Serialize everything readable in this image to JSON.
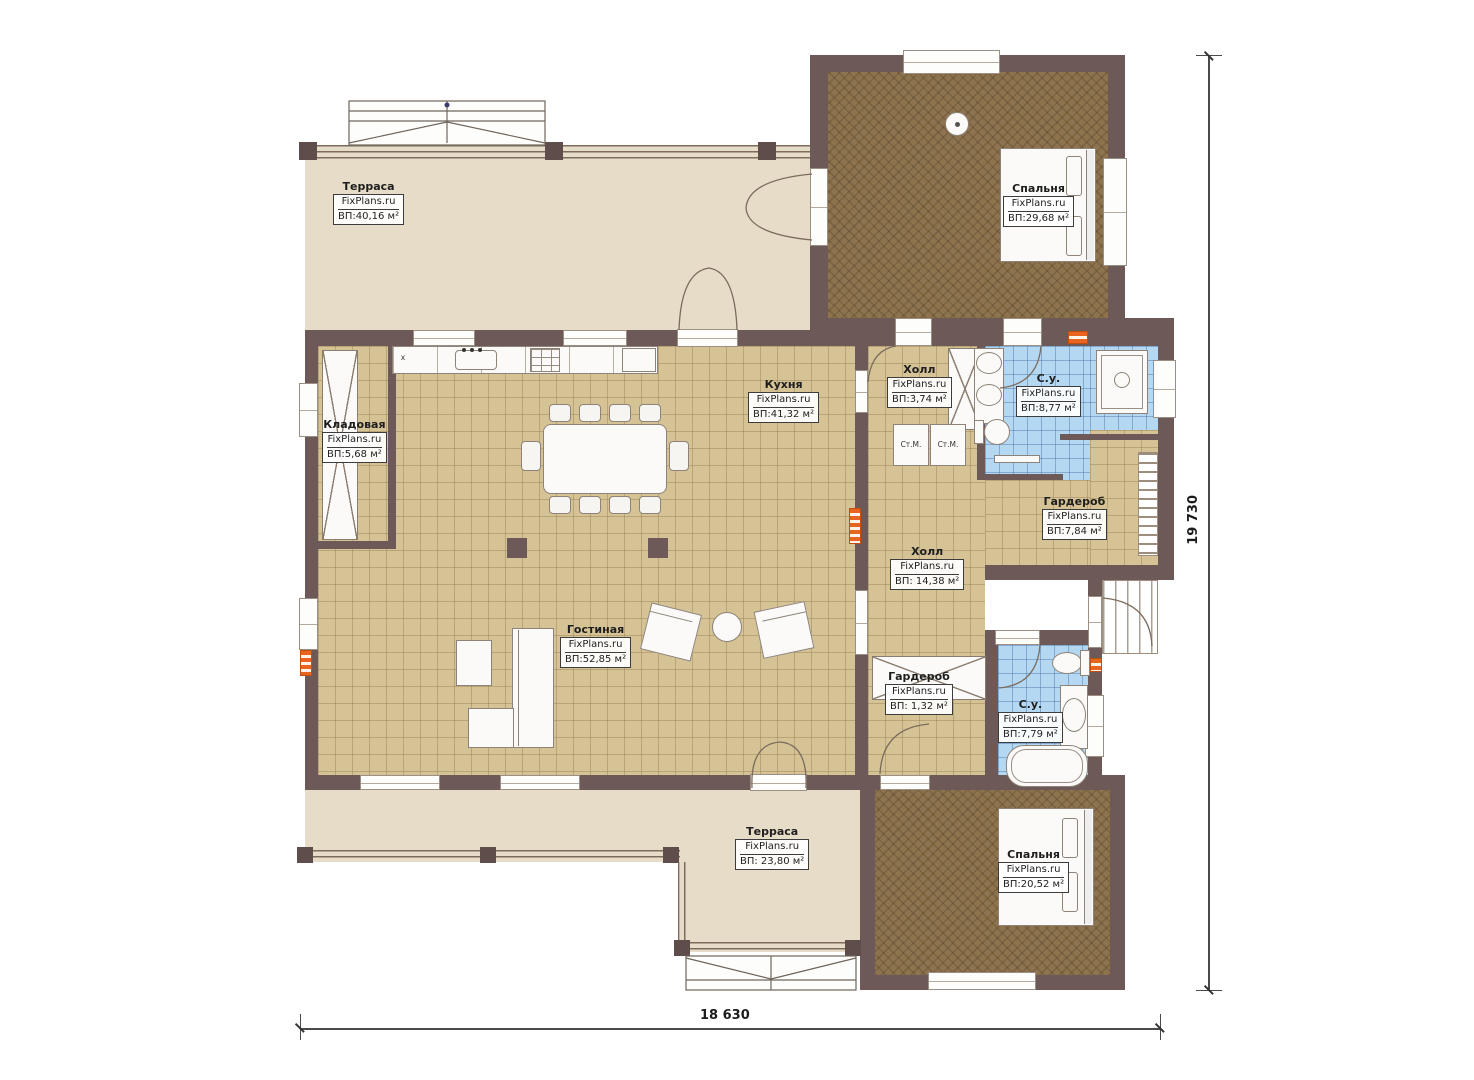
{
  "brand": "FixPlans.ru",
  "rooms": {
    "terrace_top": {
      "name": "Терраса",
      "brand": "FixPlans.ru",
      "area": "ВП:40,16 м²"
    },
    "bedroom_top": {
      "name": "Спальня",
      "brand": "FixPlans.ru",
      "area": "ВП:29,68 м²"
    },
    "storage": {
      "name": "Кладовая",
      "brand": "FixPlans.ru",
      "area": "ВП:5,68 м²"
    },
    "kitchen": {
      "name": "Кухня",
      "brand": "FixPlans.ru",
      "area": "ВП:41,32 м²"
    },
    "hall_top": {
      "name": "Холл",
      "brand": "FixPlans.ru",
      "area": "ВП:3,74 м²"
    },
    "bathroom_top": {
      "name": "С.у.",
      "brand": "FixPlans.ru",
      "area": "ВП:8,77 м²"
    },
    "wardrobe_top": {
      "name": "Гардероб",
      "brand": "FixPlans.ru",
      "area": "ВП:7,84 м²"
    },
    "hall_main": {
      "name": "Холл",
      "brand": "FixPlans.ru",
      "area": "ВП: 14,38 м²"
    },
    "living": {
      "name": "Гостиная",
      "brand": "FixPlans.ru",
      "area": "ВП:52,85 м²"
    },
    "wardrobe_small": {
      "name": "Гардероб",
      "brand": "FixPlans.ru",
      "area": "ВП: 1,32 м²"
    },
    "bathroom_bottom": {
      "name": "С.у.",
      "brand": "FixPlans.ru",
      "area": "ВП:7,79 м²"
    },
    "terrace_bottom": {
      "name": "Терраса",
      "brand": "FixPlans.ru",
      "area": "ВП: 23,80 м²"
    },
    "bedroom_bottom": {
      "name": "Спальня",
      "brand": "FixPlans.ru",
      "area": "ВП:20,52 м²"
    }
  },
  "appliances": {
    "washer_label": "Ст.М.",
    "cooktop_mark": "x"
  },
  "dimensions": {
    "horizontal": "18 630",
    "vertical": "19 730"
  },
  "colors": {
    "wall": "#6d5a58",
    "terrace": "#e7dcc7",
    "floor_tan": "#d5c295",
    "floor_brown": "#8d744f",
    "floor_blue": "#b5d8f2",
    "accent_orange": "#e8641f"
  }
}
